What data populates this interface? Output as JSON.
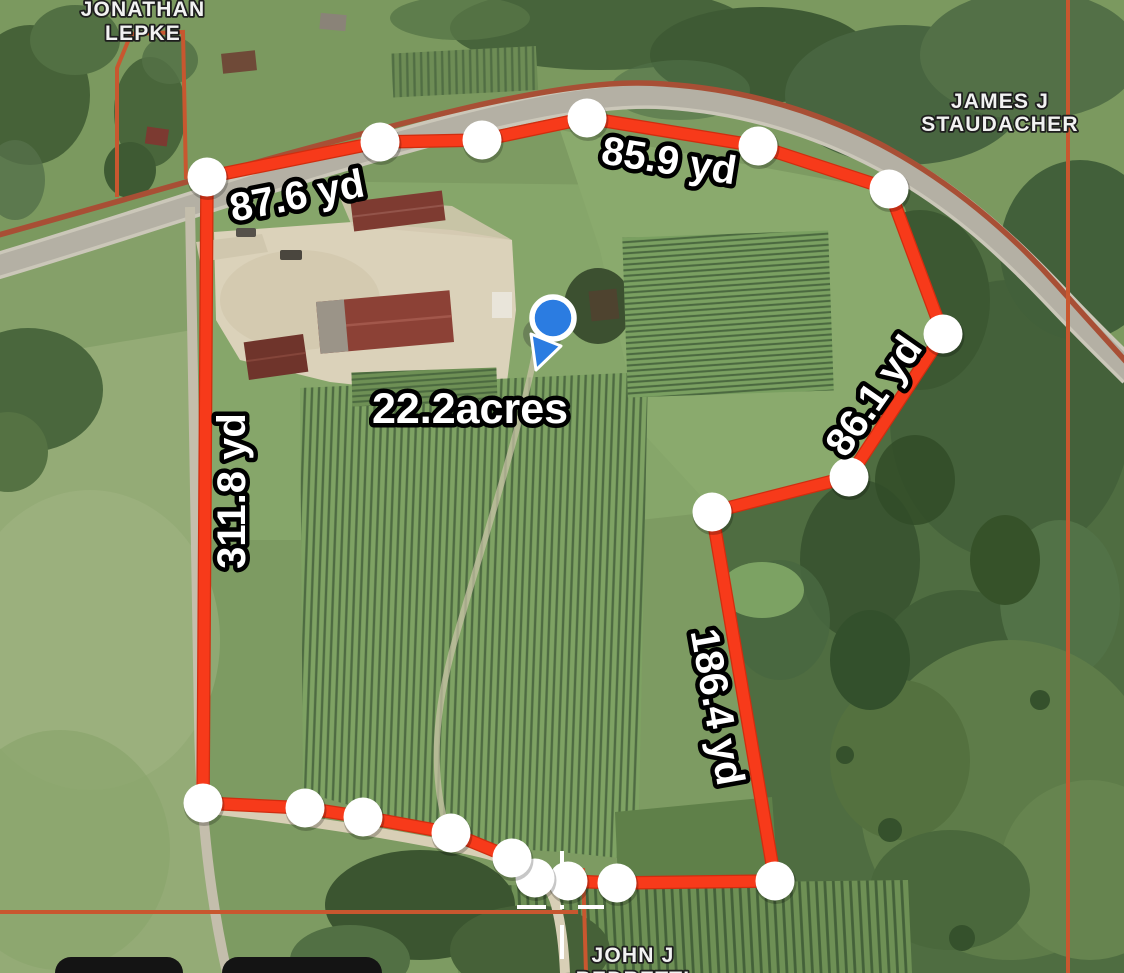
{
  "area_label": {
    "text": "22.2acres"
  },
  "measurements": [
    {
      "text": "87.6 yd"
    },
    {
      "text": "85.9 yd"
    },
    {
      "text": "86.1 yd"
    },
    {
      "text": "311.8 yd"
    },
    {
      "text": "186.4 yd"
    }
  ],
  "owners": {
    "lepke": {
      "line1": "JONATHAN",
      "line2": "LEPKE"
    },
    "staudacher": {
      "line1": "JAMES J",
      "line2": "STAUDACHER"
    },
    "bedretti": {
      "line1": "JOHN J",
      "line2": "BEDRETTI"
    }
  },
  "boundary": {
    "color": "#f73a1a",
    "casing_color": "#d02d0f",
    "vertex_fill": "#ffffff",
    "vertex_radius": 19.5,
    "vertices_px": [
      [
        207,
        177
      ],
      [
        380,
        142
      ],
      [
        482,
        140
      ],
      [
        587,
        118
      ],
      [
        758,
        146
      ],
      [
        889,
        189
      ],
      [
        943,
        334
      ],
      [
        849,
        477
      ],
      [
        712,
        512
      ],
      [
        775,
        881
      ],
      [
        617,
        883
      ],
      [
        568,
        881
      ],
      [
        535,
        878
      ],
      [
        512,
        858
      ],
      [
        451,
        833
      ],
      [
        363,
        817
      ],
      [
        305,
        808
      ],
      [
        203,
        803
      ]
    ]
  },
  "parcel_lines": {
    "color": "#c8572f"
  },
  "pin": {
    "fill": "#2b7ce1",
    "ring": "#ffffff"
  },
  "crosshair": {
    "color": "#ffffff"
  },
  "bottom_buttons": {
    "color": "#141414",
    "count": 2
  }
}
